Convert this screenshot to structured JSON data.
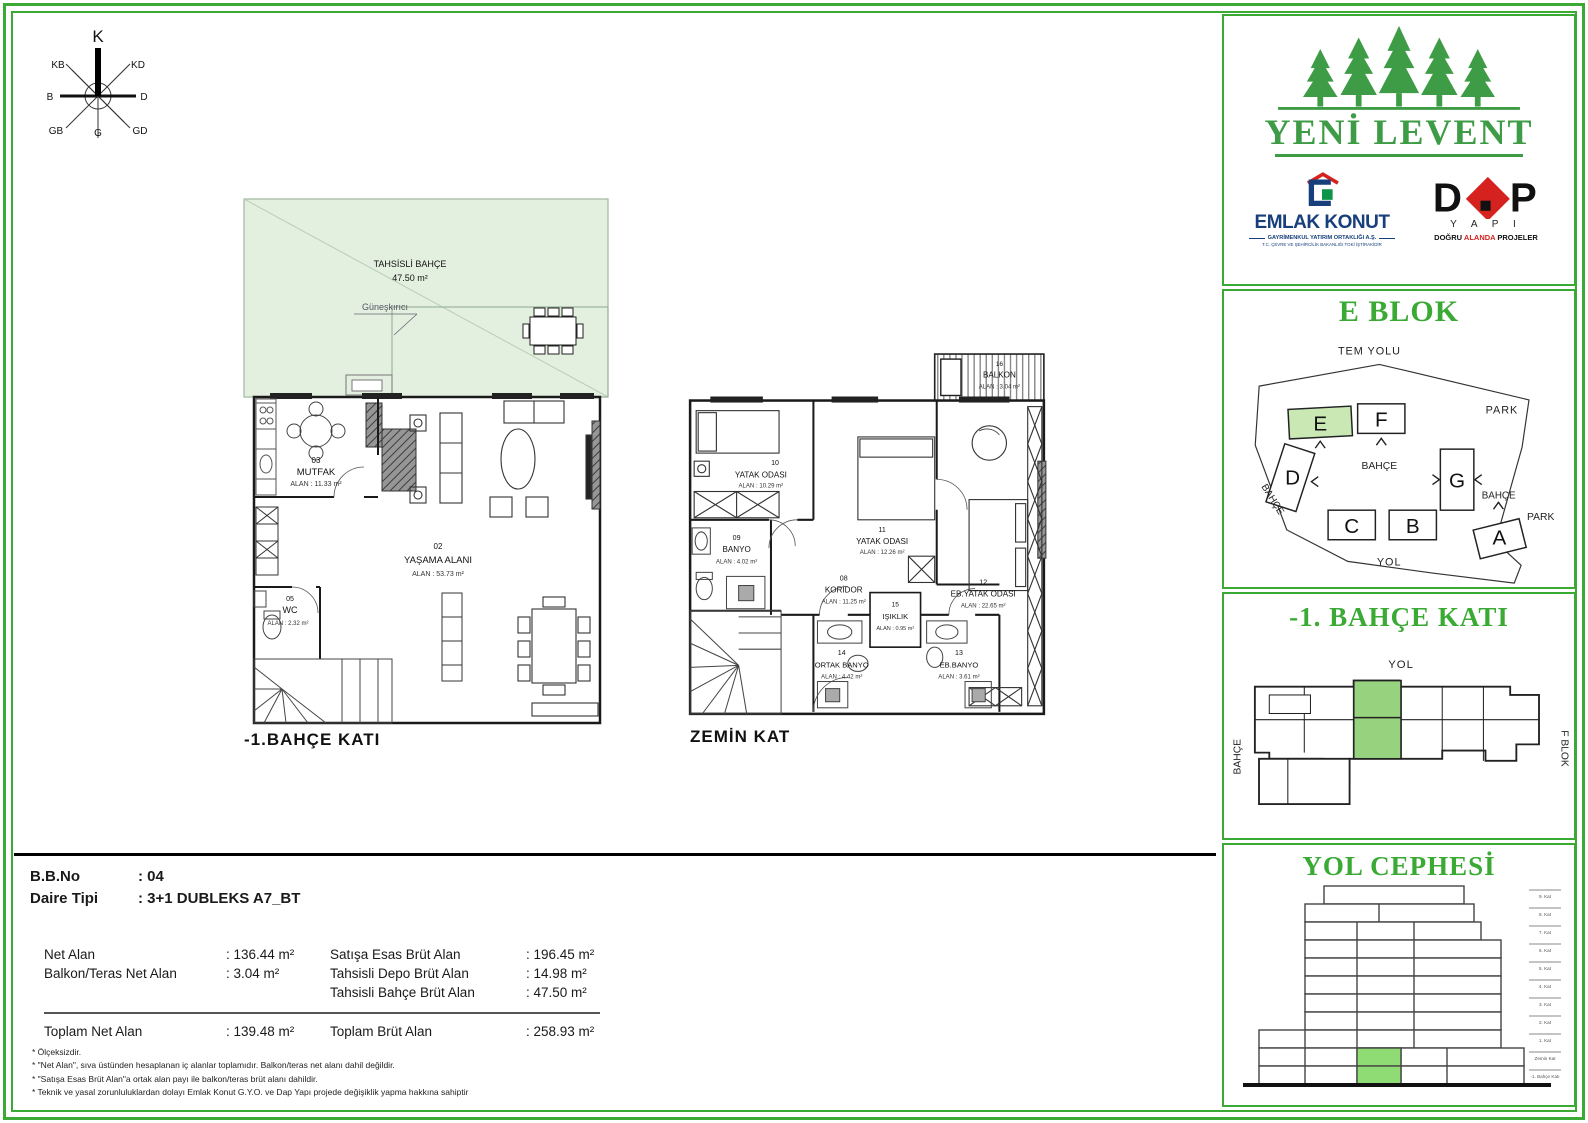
{
  "compass": {
    "n": "K",
    "ne": "KD",
    "e": "D",
    "se": "GD",
    "s": "G",
    "sw": "GB",
    "w": "B",
    "nw": "KB"
  },
  "plans": {
    "basement_title": "-1.BAHÇE  KATI",
    "ground_title": "ZEMİN  KAT"
  },
  "basement": {
    "garden_name": "TAHSİSLİ BAHÇE",
    "garden_area": "47.50 m²",
    "sun_breaker": "Güneşkırıcı",
    "rooms": [
      {
        "num": "03",
        "name": "MUTFAK",
        "area": "ALAN : 11.33 m²"
      },
      {
        "num": "02",
        "name": "YAŞAMA ALANI",
        "area": "ALAN : 53.73 m²"
      },
      {
        "num": "05",
        "name": "WC",
        "area": "ALAN : 2.32 m²"
      }
    ]
  },
  "ground": {
    "rooms": [
      {
        "num": "16",
        "name": "BALKON",
        "area": "ALAN : 3.04 m²"
      },
      {
        "num": "10",
        "name": "YATAK ODASI",
        "area": "ALAN : 10.29 m²"
      },
      {
        "num": "11",
        "name": "YATAK ODASI",
        "area": "ALAN : 12.26 m²"
      },
      {
        "num": "12",
        "name": "EB.YATAK ODASI",
        "area": "ALAN : 22.65 m²"
      },
      {
        "num": "09",
        "name": "BANYO",
        "area": "ALAN : 4.02 m²"
      },
      {
        "num": "08",
        "name": "KORİDOR",
        "area": "ALAN : 11.25 m²"
      },
      {
        "num": "15",
        "name": "IŞIKLIK",
        "area": "ALAN : 0.95 m²"
      },
      {
        "num": "14",
        "name": "ORTAK BANYO",
        "area": "ALAN : 4.42 m²"
      },
      {
        "num": "13",
        "name": "EB.BANYO",
        "area": "ALAN : 3.61 m²"
      }
    ]
  },
  "brand": {
    "project": "YENİ LEVENT",
    "emlak": {
      "name": "EMLAK KONUT",
      "line1": "GAYRİMENKUL YATIRIM ORTAKLIĞI A.Ş.",
      "line2": "T.C. ÇEVRE VE ŞEHİRCİLİK BAKANLIĞI TOKİ İŞTİRAKİDİR"
    },
    "dap": {
      "yapi": "Y A P I",
      "tag_pre": "DOĞRU ",
      "tag_mid": "ALANDA",
      "tag_post": " PROJELER"
    }
  },
  "site": {
    "title": "E BLOK",
    "tem_yolu": "TEM YOLU",
    "park_top": "PARK",
    "park_bottom": "PARK",
    "bahce_left": "BAHÇE",
    "bahce_center": "BAHÇE",
    "bahce_right": "BAHÇE",
    "yol": "YOL",
    "blocks": {
      "a": "A",
      "b": "B",
      "c": "C",
      "d": "D",
      "e": "E",
      "f": "F",
      "g": "G"
    }
  },
  "floorkey": {
    "title": "-1. BAHÇE KATI",
    "yol": "YOL",
    "bahce": "BAHÇE",
    "fblok": "F BLOK"
  },
  "elevation": {
    "title": "YOL CEPHESİ",
    "floors": [
      "9. Kat",
      "8. Kat",
      "7. Kat",
      "6. Kat",
      "5. Kat",
      "4. Kat",
      "3. Kat",
      "2. Kat",
      "1. Kat",
      "Zemin Kat",
      "-1. Bahçe Katı"
    ]
  },
  "info": {
    "bb_label": "B.B.No",
    "bb_value": ": 04",
    "type_label": "Daire  Tipi",
    "type_value": ": 3+1 DUBLEKS  A7_BT",
    "net_label": "Net Alan",
    "net_value": ": 136.44 m²",
    "balkon_label": "Balkon/Teras Net Alan",
    "balkon_value": ": 3.04 m²",
    "satis_label": "Satışa Esas Brüt Alan",
    "satis_value": ": 196.45 m²",
    "depo_label": "Tahsisli Depo Brüt Alan",
    "depo_value": ": 14.98 m²",
    "bahce_label": "Tahsisli Bahçe Brüt Alan",
    "bahce_value": ": 47.50 m²",
    "toplam_net_label": "Toplam Net Alan",
    "toplam_net_value": ": 139.48 m²",
    "toplam_brut_label": "Toplam Brüt Alan",
    "toplam_brut_value": ": 258.93 m²"
  },
  "footnotes": [
    "*   Ölçeksizdir.",
    "*   \"Net Alan\", sıva üstünden hesaplanan iç alanlar toplamıdır. Balkon/teras net alanı dahil değildir.",
    "*   \"Satışa Esas Brüt Alan\"a ortak alan payı ile balkon/teras brüt alanı dahildir.",
    "*   Teknik ve yasal zorunluluklardan dolayı Emlak Konut G.Y.O. ve Dap Yapı projede değişiklik yapma hakkına sahiptir"
  ]
}
